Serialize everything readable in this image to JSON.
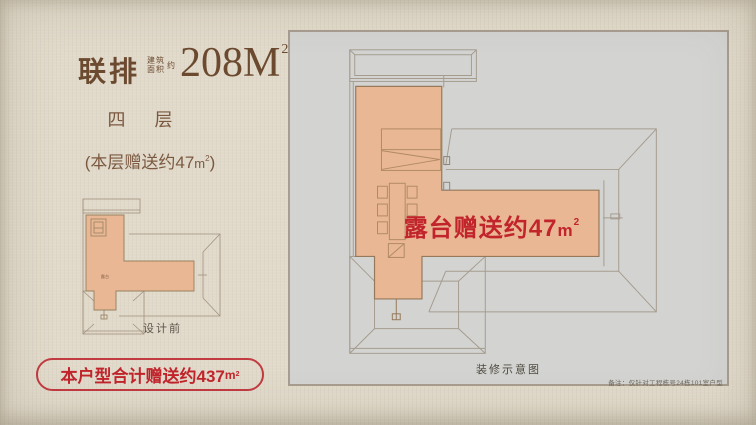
{
  "title": {
    "type": "联排",
    "prefix_row1": "建筑",
    "prefix_row2": "面积",
    "prefix_side": "约",
    "area_value": "208M",
    "area_sup": "2"
  },
  "units": {
    "m": "m",
    "sup": "2"
  },
  "left": {
    "floor_label": "四 层",
    "note_pre": "(本层赠送约47",
    "note_close": ")",
    "plan_caption": "设计前",
    "plan_room": "露台",
    "pill_text": "本户型合计赠送约437"
  },
  "panel": {
    "terrace_pre": "露台赠送约47",
    "caption": "装修示意图",
    "note": "备注：仅针对工程栋号24栋101室户型"
  },
  "colors": {
    "accent_red": "#c2242c",
    "title_brown": "#6c4a30",
    "terrace_fill": "#eab795",
    "panel_bg": "#d3d4d2",
    "background": "#e1dacb"
  }
}
